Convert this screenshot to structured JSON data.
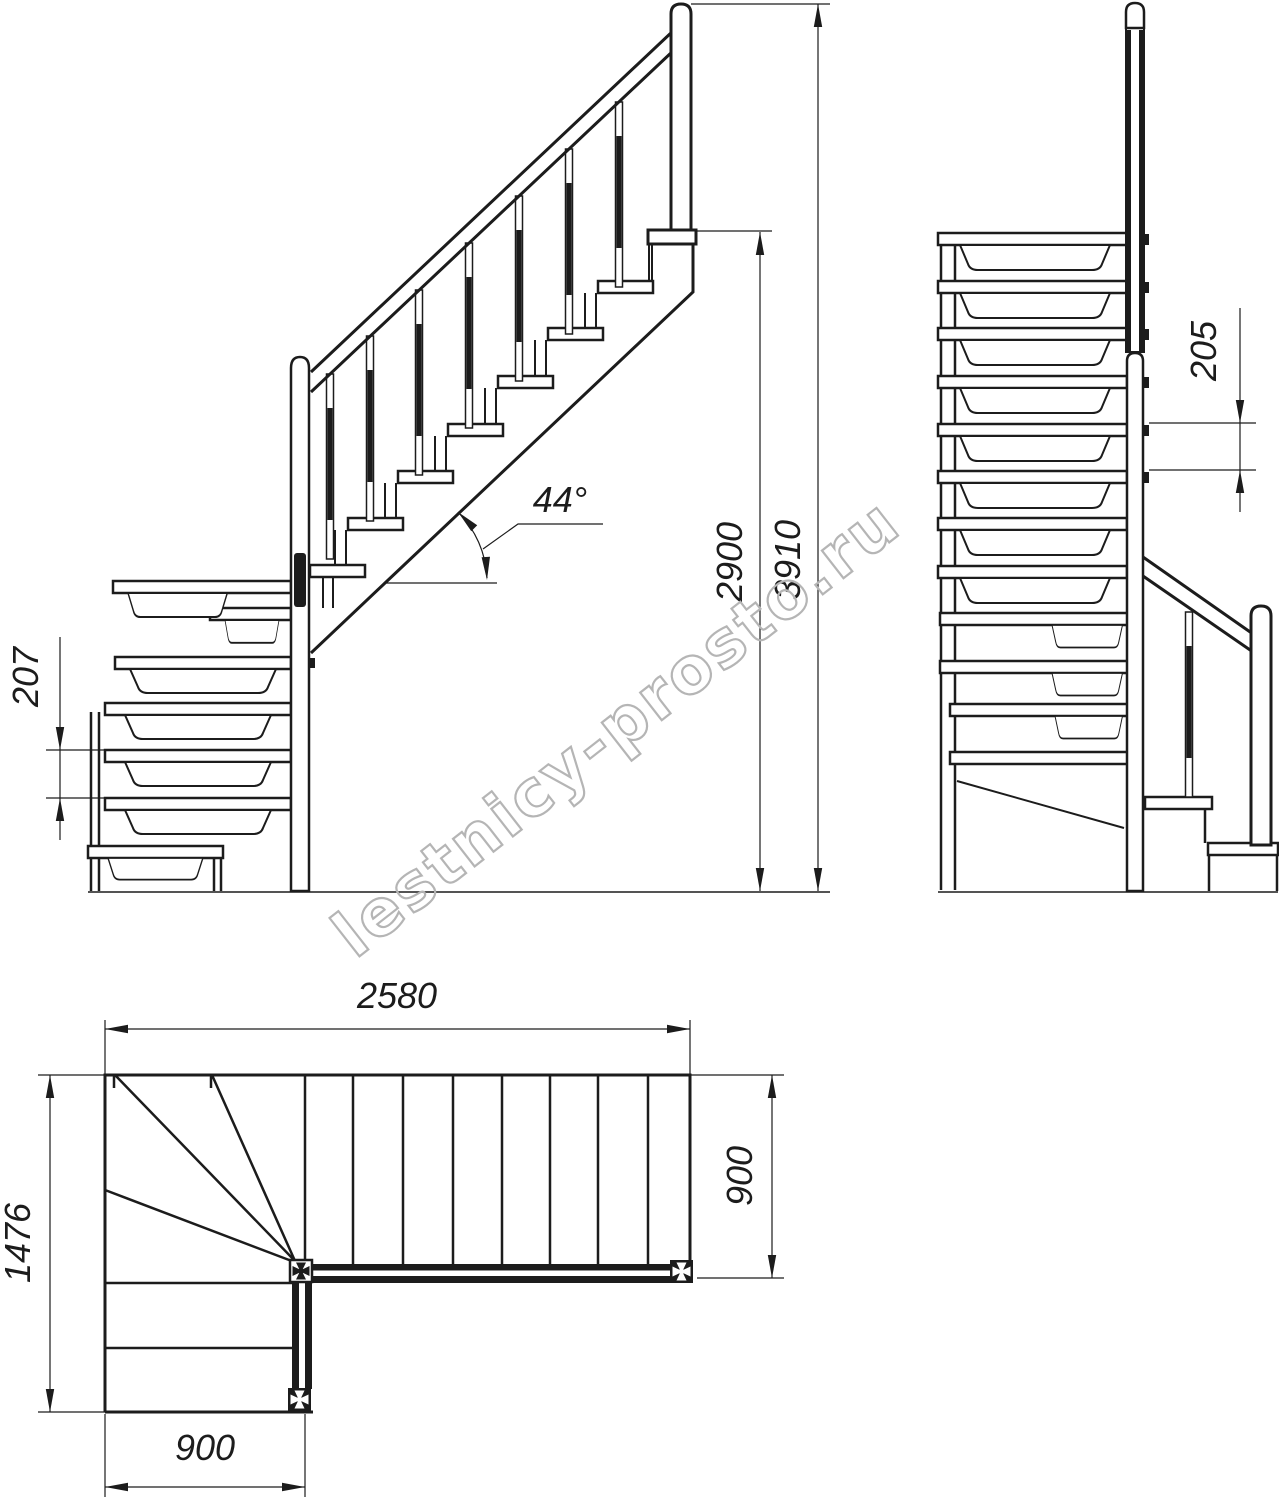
{
  "watermark": {
    "text": "lestnicy-prosto.ru"
  },
  "side_view": {
    "step_rise": "207",
    "slope_angle": "44°",
    "landing_height": "2900",
    "total_height": "3910"
  },
  "front_view": {
    "step_rise": "205"
  },
  "plan_view": {
    "total_length": "2580",
    "total_width": "1476",
    "upper_flight_width": "900",
    "lower_flight_width": "900"
  },
  "colors": {
    "line": "#1c1c1c",
    "watermark": "#b5b5b5",
    "background": "#ffffff"
  }
}
